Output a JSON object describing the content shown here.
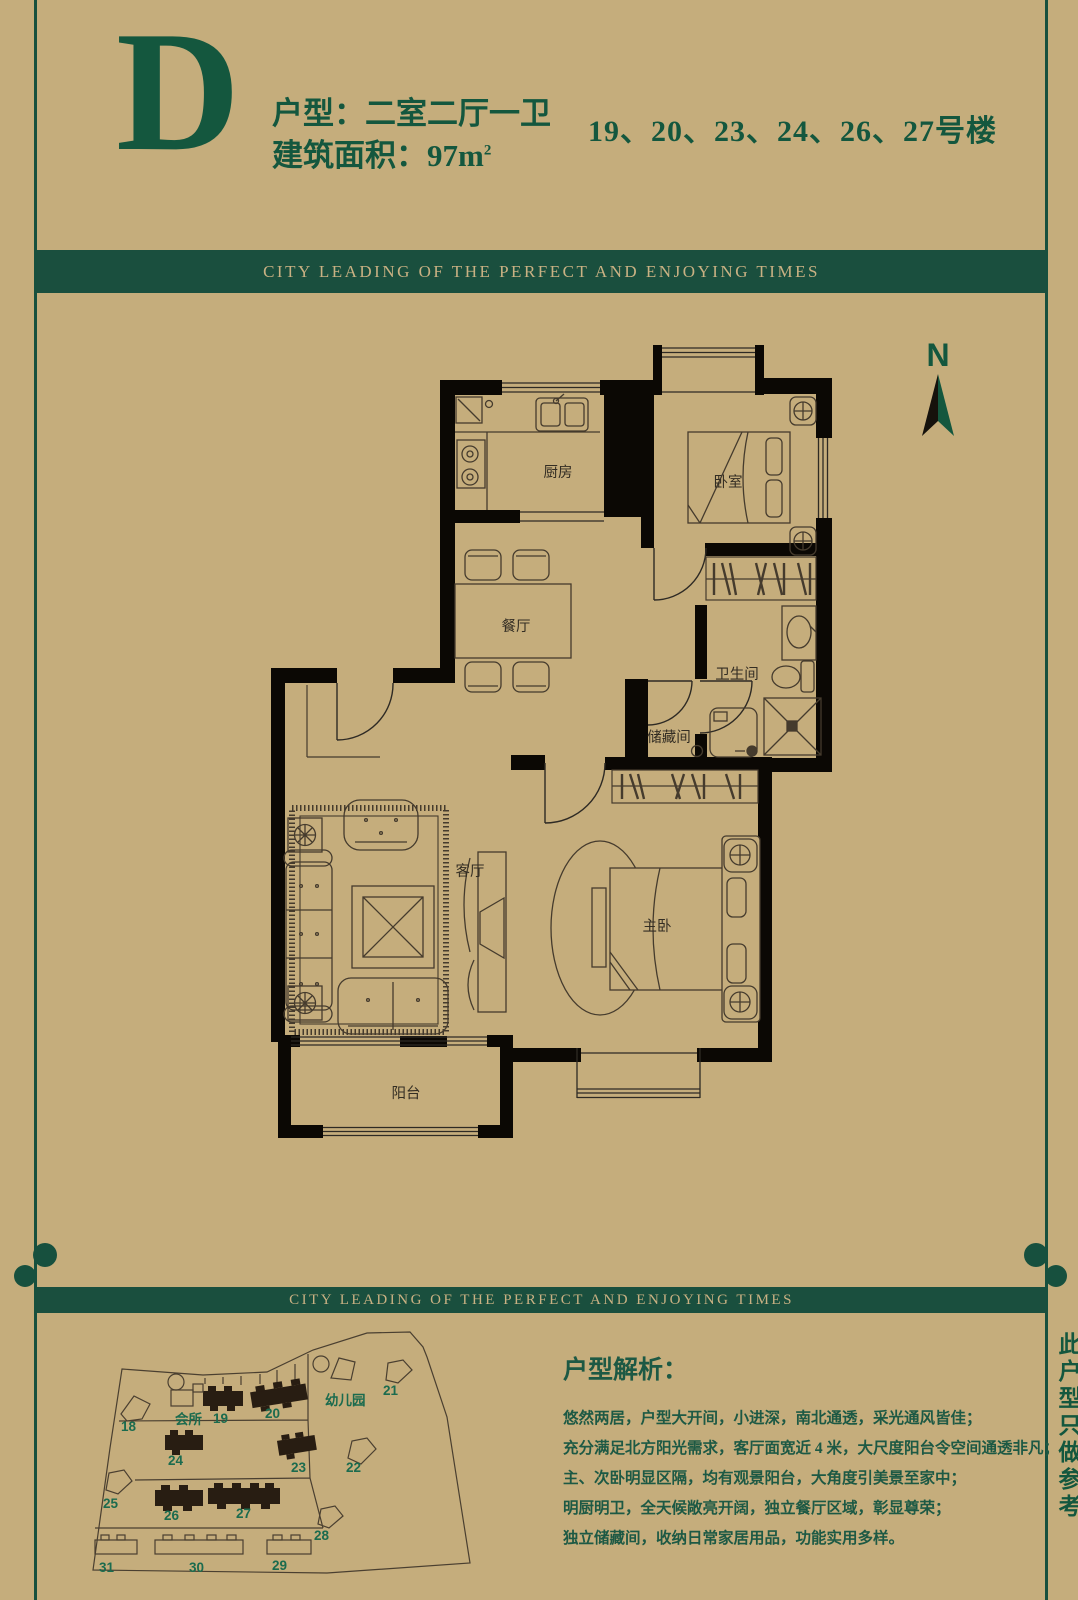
{
  "colors": {
    "background": "#c5ad7c",
    "accent_green": "#14573e",
    "banner_green": "#1a4f3e",
    "banner_gold": "#c9b183",
    "wall_black": "#0b0804"
  },
  "header": {
    "unit_letter": "D",
    "unit_type": "户型：二室二厅一卫",
    "area_prefix": "建筑面积：97m",
    "area_sup": "2",
    "buildings": "19、20、23、24、26、27号楼"
  },
  "banner": {
    "text": "CITY LEADING OF THE PERFECT AND ENJOYING TIMES"
  },
  "compass": {
    "label": "N"
  },
  "floor_plan": {
    "labels": {
      "kitchen": "厨房",
      "bedroom": "卧室",
      "dining": "餐厅",
      "bathroom": "卫生间",
      "storage": "储藏间",
      "living": "客厅",
      "master": "主卧",
      "balcony": "阳台"
    }
  },
  "site_map": {
    "labels": {
      "b18": "18",
      "b19": "19",
      "b20": "20",
      "b21": "21",
      "b22": "22",
      "b23": "23",
      "b24": "24",
      "b25": "25",
      "b26": "26",
      "b27": "27",
      "b28": "28",
      "b29": "29",
      "b30": "30",
      "b31": "31",
      "clubhouse": "会所",
      "kindergarten": "幼儿园"
    }
  },
  "analysis": {
    "heading": "户型解析：",
    "lines": [
      "悠然两居，户型大开间，小进深，南北通透，采光通风皆佳；",
      "充分满足北方阳光需求，客厅面宽近 4 米，大尺度阳台令空间通透非凡；",
      "主、次卧明显区隔，均有观景阳台，大角度引美景至家中；",
      "明厨明卫，全天候敞亮开阔，独立餐厅区域，彰显尊荣；",
      "独立储藏间，收纳日常家居用品，功能实用多样。"
    ]
  },
  "side_note": {
    "text": "此户型只做参考"
  }
}
